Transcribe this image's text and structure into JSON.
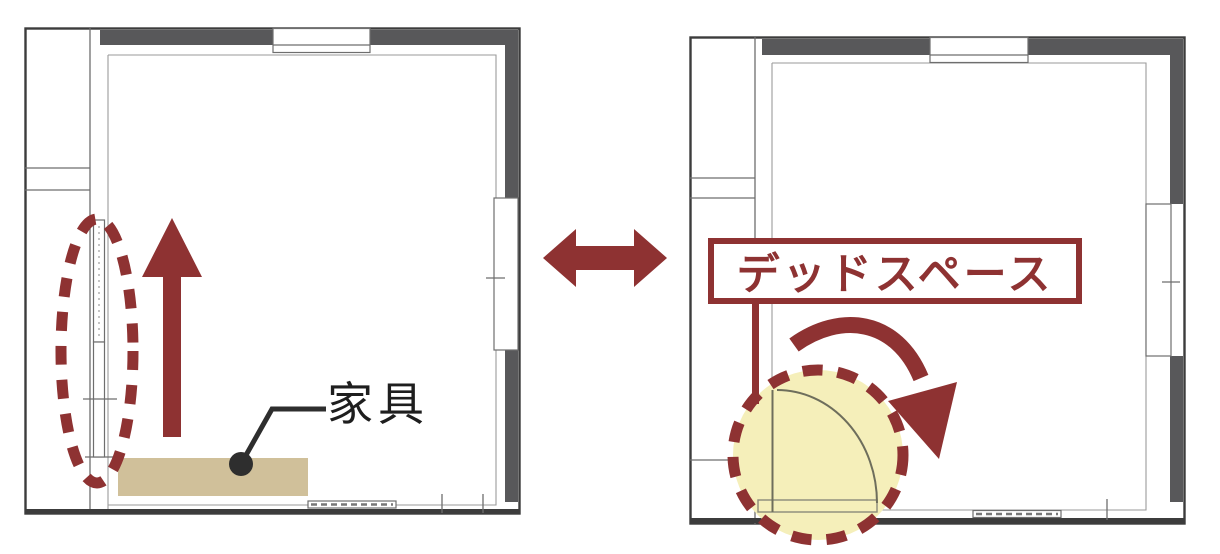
{
  "diagram": {
    "left_plan": {
      "furniture_label": "家具",
      "flow_icon": "up-arrow-icon",
      "highlight_icon": "dashed-ellipse-highlight"
    },
    "comparison_icon": "left-right-arrow-icon",
    "right_plan": {
      "dead_space_label": "デッドスペース",
      "flow_icon": "door-swing-arrow-icon",
      "highlight_icon": "dashed-circle-highlight"
    },
    "colors": {
      "accent_red": "#8e3232",
      "furniture_tan": "#d0c09a",
      "highlight_yellow": "#f5efba",
      "wall_gray": "#58585a"
    }
  }
}
